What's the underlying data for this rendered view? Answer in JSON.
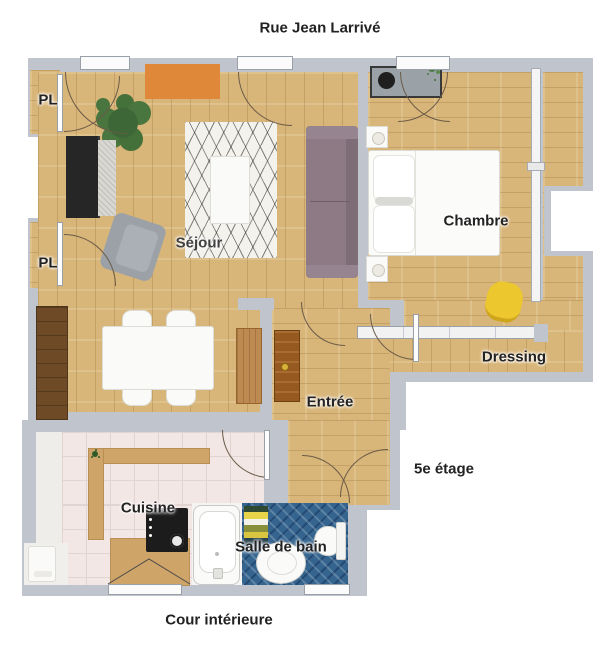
{
  "plan": {
    "street_label": "Rue Jean Larrivé",
    "floor_label": "5e étage",
    "courtyard_label": "Cour intérieure",
    "rooms": {
      "living": "Séjour",
      "bedroom": "Chambre",
      "dressing": "Dressing",
      "entry": "Entrée",
      "kitchen": "Cuisine",
      "bathroom": "Salle de bain",
      "closet_upper": "PL",
      "closet_lower": "PL"
    },
    "colors": {
      "wall": "#c0c4cc",
      "wood_floor": "#d8b578",
      "accent_rug_orange": "#e0883a",
      "sofa_purple": "#8d7a84",
      "armchair_gray": "#9ba1a7",
      "chair_yellow": "#ecc72e",
      "plant_green": "#49763f",
      "bath_tile_blue": "#35648f",
      "kitchen_tile_pink": "#f2e7e5",
      "front_door_brown": "#96591f",
      "sideboard_brown": "#6e4a26",
      "label_text": "#222222"
    }
  }
}
